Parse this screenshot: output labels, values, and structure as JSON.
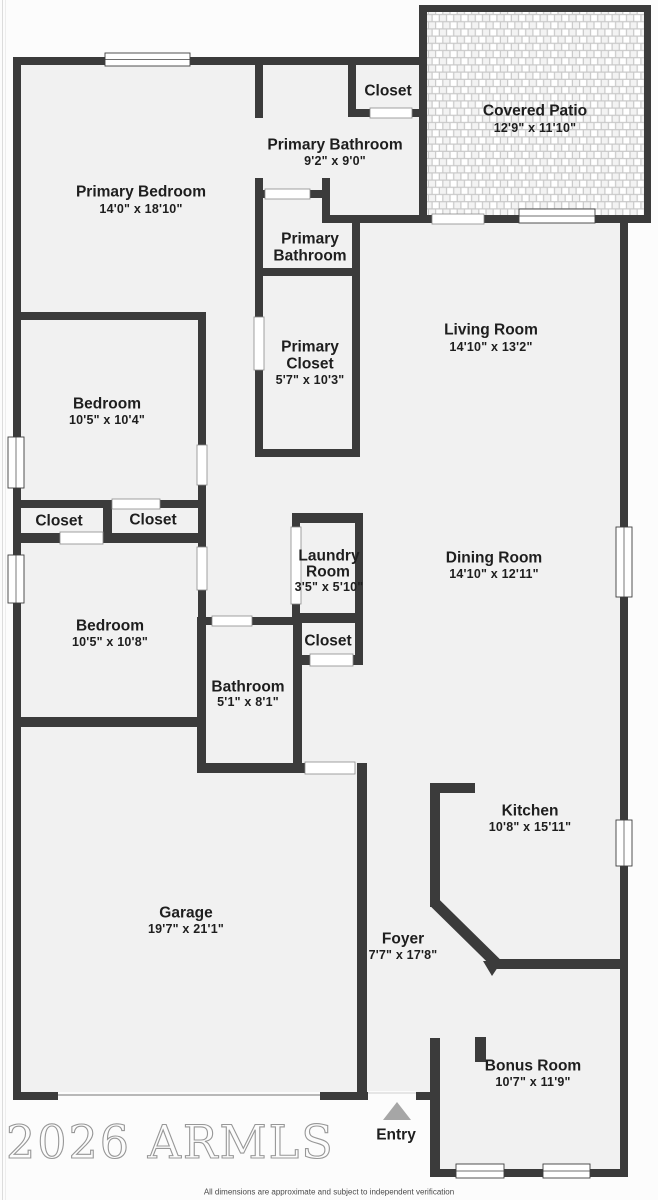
{
  "plan": {
    "watermark": "2026 ARMLS",
    "disclaimer": "All dimensions are approximate and subject to independent verification",
    "colors": {
      "wall": "#3b3b3b",
      "room_fill": "#f1f1f1",
      "background": "#fcfcfc",
      "patio_grout": "#c9c9c9",
      "entry_arrow": "#a6a6a6",
      "watermark": "#8d8d8d",
      "label_text": "#1e1e1e"
    },
    "rooms": {
      "covered_patio": {
        "name": "Covered Patio",
        "dims": "12'9\" x 11'10\""
      },
      "top_closet": {
        "name": "Closet"
      },
      "primary_bathroom": {
        "name": "Primary Bathroom",
        "dims": "9'2\" x 9'0\""
      },
      "primary_bedroom": {
        "name": "Primary Bedroom",
        "dims": "14'0\" x 18'10\""
      },
      "primary_bathroom_2": {
        "name": "Primary",
        "name2": "Bathroom"
      },
      "primary_closet": {
        "name": "Primary",
        "name2": "Closet",
        "dims": "5'7\" x 10'3\""
      },
      "living_room": {
        "name": "Living Room",
        "dims": "14'10\" x 13'2\""
      },
      "bedroom_1": {
        "name": "Bedroom",
        "dims": "10'5\" x 10'4\""
      },
      "closet_left": {
        "name": "Closet"
      },
      "closet_right": {
        "name": "Closet"
      },
      "laundry_room": {
        "name": "Laundry",
        "name2": "Room",
        "dims": "3'5\" x 5'10\""
      },
      "dining_room": {
        "name": "Dining Room",
        "dims": "14'10\" x 12'11\""
      },
      "bedroom_2": {
        "name": "Bedroom",
        "dims": "10'5\" x 10'8\""
      },
      "closet_middle": {
        "name": "Closet"
      },
      "bathroom": {
        "name": "Bathroom",
        "dims": "5'1\" x 8'1\""
      },
      "garage": {
        "name": "Garage",
        "dims": "19'7\" x 21'1\""
      },
      "kitchen": {
        "name": "Kitchen",
        "dims": "10'8\" x 15'11\""
      },
      "foyer": {
        "name": "Foyer",
        "dims": "7'7\" x 17'8\""
      },
      "bonus_room": {
        "name": "Bonus Room",
        "dims": "10'7\" x 11'9\""
      },
      "entry": {
        "name": "Entry"
      }
    }
  }
}
